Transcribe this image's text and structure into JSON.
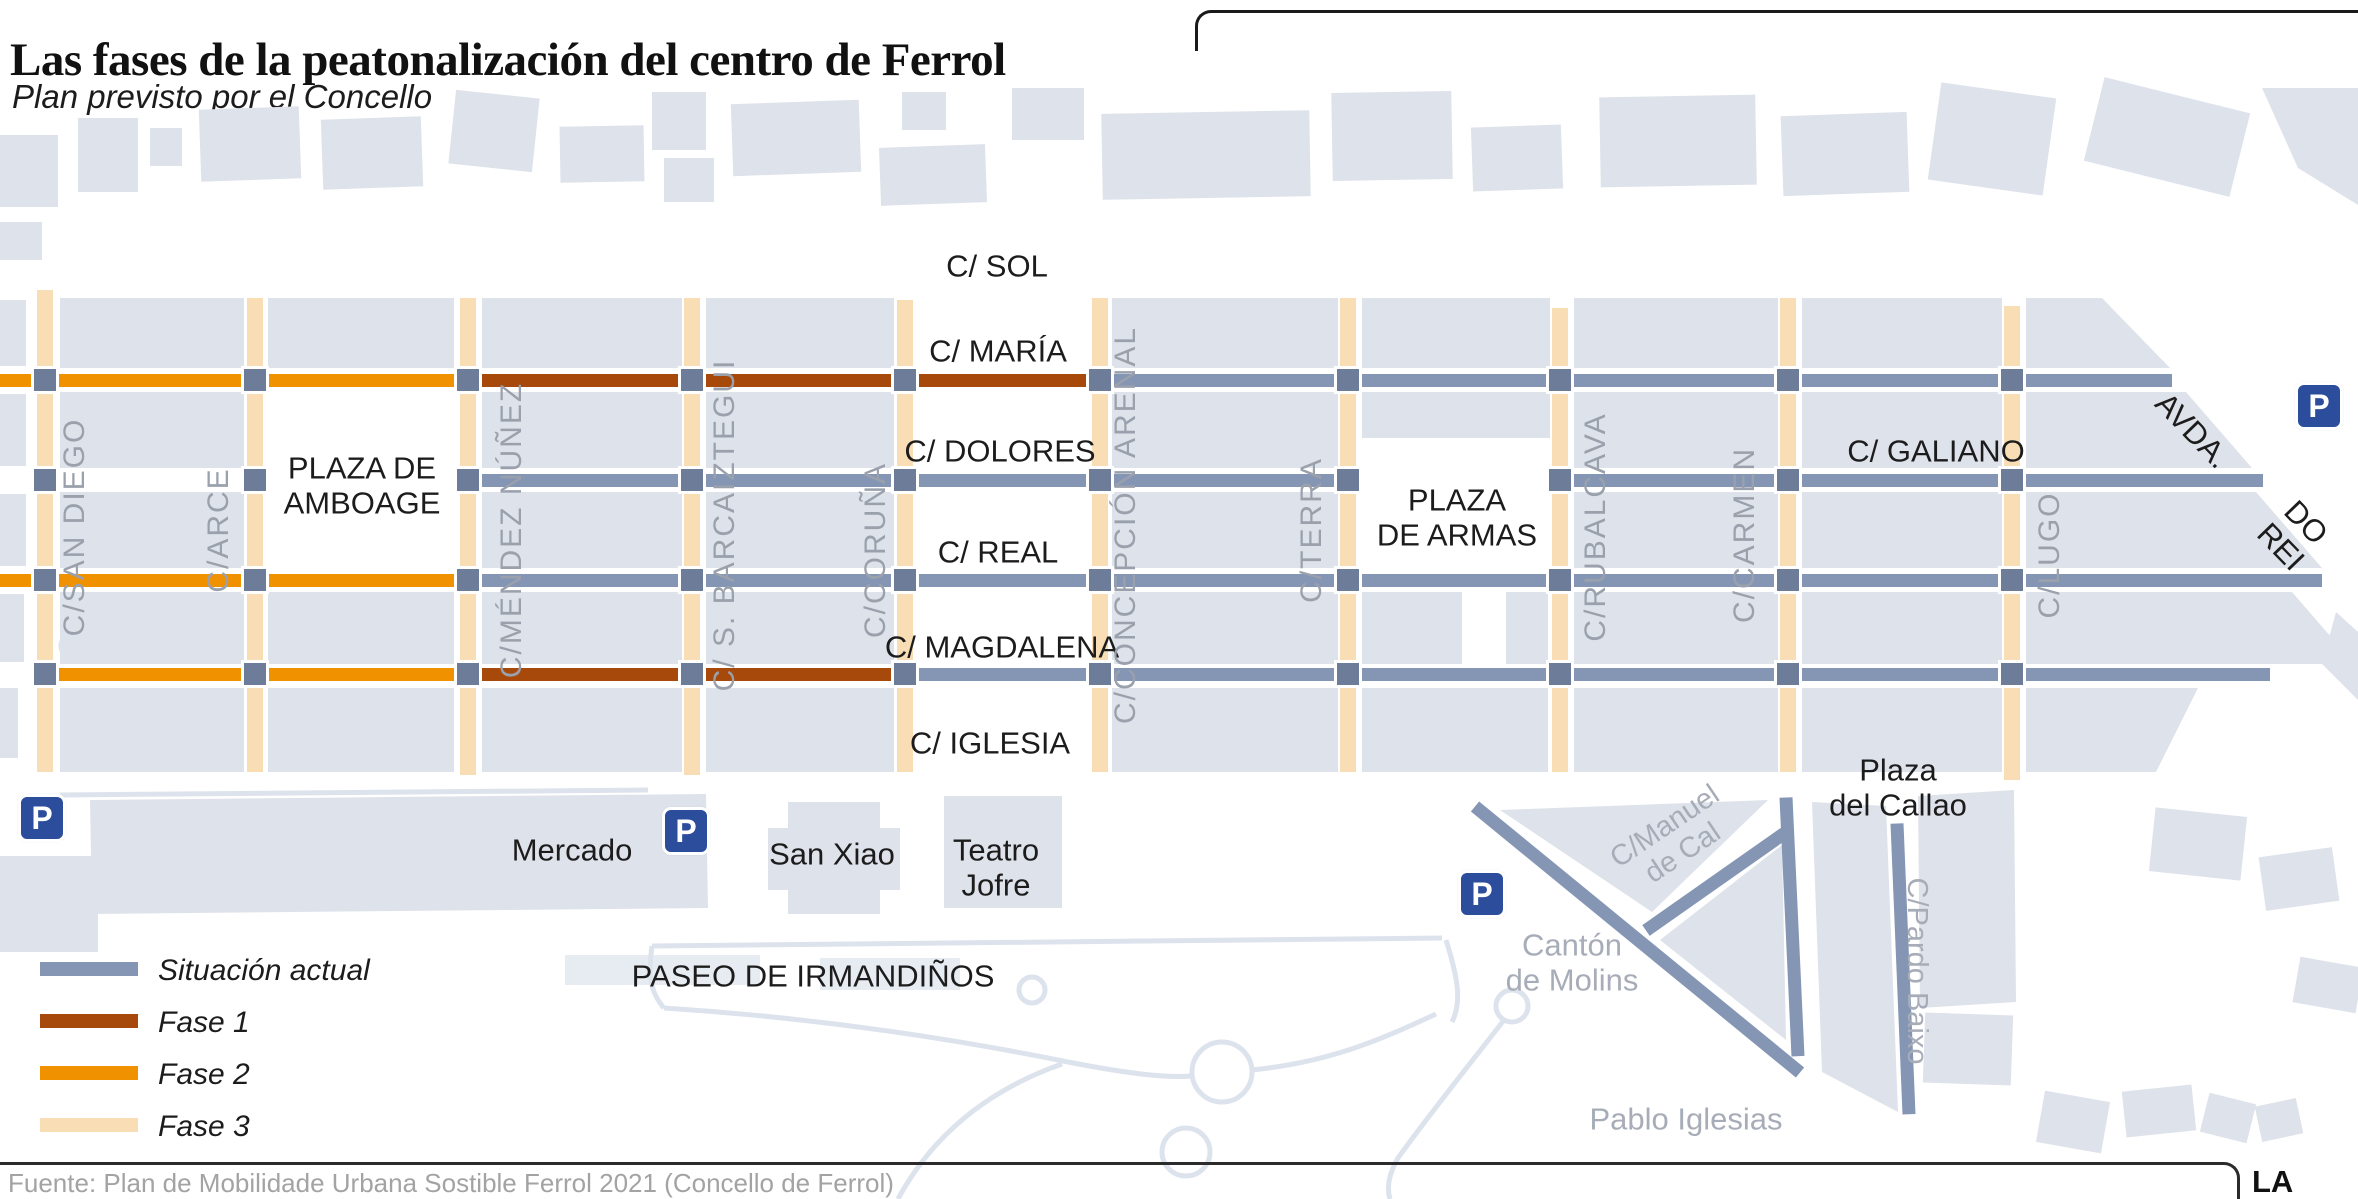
{
  "title": "Las fases de la peatonalización del centro de Ferrol",
  "subtitle": "Plan previsto por el Concello",
  "source": "Fuente: Plan de Mobilidade Urbana Sostible Ferrol 2021 (Concello de Ferrol)",
  "brand": "LA VOZ",
  "legend": {
    "items": [
      {
        "label": "Situación actual",
        "color": "#8496b4"
      },
      {
        "label": "Fase 1",
        "color": "#a8490c"
      },
      {
        "label": "Fase 2",
        "color": "#f09200"
      },
      {
        "label": "Fase 3",
        "color": "#f9ddb4"
      }
    ]
  },
  "colors": {
    "actual": "#8496b4",
    "fase1": "#a8490c",
    "fase2": "#f09200",
    "fase3": "#f9ddb4",
    "square": "#6c7c99",
    "building": "#dee2ea",
    "building_light": "#e7ebf2",
    "path": "#dde3ec",
    "parking_bg": "#2b4d9c",
    "label_black": "#1c1c1c",
    "label_gray_street": "#9aa1ac",
    "label_gray_place": "#a7adb8"
  },
  "map": {
    "parking_label": "P",
    "parking": [
      {
        "x": 42,
        "y": 818
      },
      {
        "x": 686,
        "y": 831
      },
      {
        "x": 1482,
        "y": 894
      },
      {
        "x": 2319,
        "y": 406
      }
    ],
    "v_streets": [
      {
        "name": "san-diego",
        "x": 45,
        "y1": 290,
        "y2": 772
      },
      {
        "name": "arce",
        "x": 255,
        "y1": 298,
        "y2": 772
      },
      {
        "name": "mendez-nunez",
        "x": 468,
        "y1": 298,
        "y2": 775
      },
      {
        "name": "barcaiztegui",
        "x": 692,
        "y1": 298,
        "y2": 775
      },
      {
        "name": "coruna",
        "x": 905,
        "y1": 300,
        "y2": 772
      },
      {
        "name": "concepcion-arenal",
        "x": 1100,
        "y1": 298,
        "y2": 772
      },
      {
        "name": "terra",
        "x": 1348,
        "y1": 298,
        "y2": 772
      },
      {
        "name": "rubalcava",
        "x": 1560,
        "y1": 308,
        "y2": 772
      },
      {
        "name": "carmen",
        "x": 1788,
        "y1": 298,
        "y2": 772
      },
      {
        "name": "lugo",
        "x": 2012,
        "y1": 306,
        "y2": 780
      }
    ],
    "h_segments": [
      {
        "name": "maria-fase2",
        "y": 380,
        "x1": 0,
        "x2": 466,
        "phase": "fase2"
      },
      {
        "name": "maria-fase1",
        "y": 380,
        "x1": 466,
        "x2": 1100,
        "phase": "fase1"
      },
      {
        "name": "maria-actual",
        "y": 380,
        "x1": 1100,
        "x2": 2172,
        "phase": "actual"
      },
      {
        "name": "dolores-actual",
        "y": 480,
        "x1": 466,
        "x2": 1348,
        "phase": "actual"
      },
      {
        "name": "galiano-actual",
        "y": 480,
        "x1": 1560,
        "x2": 2263,
        "phase": "actual"
      },
      {
        "name": "real-fase2",
        "y": 580,
        "x1": 0,
        "x2": 466,
        "phase": "fase2"
      },
      {
        "name": "real-actual",
        "y": 580,
        "x1": 466,
        "x2": 2322,
        "phase": "actual"
      },
      {
        "name": "magdalena-fase2",
        "y": 674,
        "x1": 45,
        "x2": 466,
        "phase": "fase2"
      },
      {
        "name": "magdalena-fase1",
        "y": 674,
        "x1": 466,
        "x2": 905,
        "phase": "fase1"
      },
      {
        "name": "magdalena-actual",
        "y": 674,
        "x1": 905,
        "x2": 2270,
        "phase": "actual"
      }
    ],
    "d_segments": [
      {
        "name": "canton-diagonal",
        "x1": 1475,
        "y1": 806,
        "x2": 1800,
        "y2": 1072,
        "phase": "actual"
      },
      {
        "name": "canton-east",
        "x1": 1786,
        "y1": 797,
        "x2": 1798,
        "y2": 1056,
        "phase": "actual"
      },
      {
        "name": "canton-middle",
        "x1": 1646,
        "y1": 930,
        "x2": 1784,
        "y2": 833,
        "phase": "actual"
      },
      {
        "name": "pardo-baixo-line",
        "x1": 1897,
        "y1": 823,
        "x2": 1909,
        "y2": 1114,
        "phase": "actual"
      }
    ],
    "intersections": {
      "xs": [
        45,
        255,
        468,
        692,
        905,
        1100,
        1348,
        1560,
        1788,
        2012
      ],
      "ys": [
        380,
        480,
        580,
        674
      ]
    },
    "labels": [
      {
        "name": "label-c-sol",
        "text": "C/ SOL",
        "x": 997,
        "y": 267,
        "s": 31,
        "c": "label_black"
      },
      {
        "name": "label-c-maria",
        "text": "C/ MARÍA",
        "x": 998,
        "y": 352,
        "s": 31,
        "c": "label_black"
      },
      {
        "name": "label-c-dolores",
        "text": "C/ DOLORES",
        "x": 1000,
        "y": 452,
        "s": 31,
        "c": "label_black"
      },
      {
        "name": "label-c-real",
        "text": "C/ REAL",
        "x": 998,
        "y": 553,
        "s": 31,
        "c": "label_black"
      },
      {
        "name": "label-c-magdalena",
        "text": "C/ MAGDALENA",
        "x": 1002,
        "y": 648,
        "s": 31,
        "c": "label_black"
      },
      {
        "name": "label-c-iglesia",
        "text": "C/ IGLESIA",
        "x": 990,
        "y": 744,
        "s": 31,
        "c": "label_black"
      },
      {
        "name": "label-plaza-amboage",
        "text": "PLAZA DE\nAMBOAGE",
        "x": 362,
        "y": 486,
        "s": 31,
        "c": "label_black"
      },
      {
        "name": "label-plaza-armas",
        "text": "PLAZA\nDE ARMAS",
        "x": 1457,
        "y": 518,
        "s": 31,
        "c": "label_black"
      },
      {
        "name": "label-c-galiano",
        "text": "C/ GALIANO",
        "x": 1936,
        "y": 452,
        "s": 31,
        "c": "label_black"
      },
      {
        "name": "label-avda",
        "text": "AVDA.",
        "x": 2192,
        "y": 431,
        "s": 31,
        "r": 46,
        "c": "label_black"
      },
      {
        "name": "label-do-rei",
        "text": "DO REI",
        "x": 2293,
        "y": 535,
        "s": 31,
        "r": 46,
        "c": "label_black"
      },
      {
        "name": "label-mercado",
        "text": "Mercado",
        "x": 572,
        "y": 851,
        "s": 31,
        "c": "label_black"
      },
      {
        "name": "label-san-xiao",
        "text": "San Xiao",
        "x": 832,
        "y": 855,
        "s": 31,
        "c": "label_black"
      },
      {
        "name": "label-teatro-jofre",
        "text": "Teatro\nJofre",
        "x": 996,
        "y": 868,
        "s": 31,
        "c": "label_black"
      },
      {
        "name": "label-paseo-irmandinos",
        "text": "PASEO DE IRMANDIÑOS",
        "x": 813,
        "y": 977,
        "s": 31,
        "c": "label_black"
      },
      {
        "name": "label-plaza-callao",
        "text": "Plaza\ndel Callao",
        "x": 1898,
        "y": 788,
        "s": 31,
        "c": "label_black"
      },
      {
        "name": "label-canton-molins",
        "text": "Cantón\nde Molins",
        "x": 1572,
        "y": 963,
        "s": 31,
        "c": "label_gray_place"
      },
      {
        "name": "label-pablo-iglesias",
        "text": "Pablo Iglesias",
        "x": 1686,
        "y": 1120,
        "s": 31,
        "c": "label_gray_place"
      },
      {
        "name": "label-manuel-de-cal",
        "text": "C/Manuel\nde Cal",
        "x": 1674,
        "y": 840,
        "s": 29,
        "r": -34,
        "c": "label_gray_place"
      },
      {
        "name": "label-pardo-baixo",
        "text": "C/Pardo Baixo",
        "x": 1917,
        "y": 971,
        "s": 29,
        "r": 90,
        "c": "label_gray_place"
      },
      {
        "name": "label-san-diego",
        "text": "C/SAN DIEGO",
        "x": 75,
        "y": 527,
        "s": 30,
        "r": -90,
        "ls": 2,
        "c": "label_gray_street"
      },
      {
        "name": "label-arce",
        "text": "C/ARCE",
        "x": 219,
        "y": 530,
        "s": 30,
        "r": -90,
        "ls": 2,
        "c": "label_gray_street"
      },
      {
        "name": "label-mendez-nunez",
        "text": "C/MÉNDEZ NÚÑEZ",
        "x": 512,
        "y": 530,
        "s": 30,
        "r": -90,
        "ls": 2,
        "c": "label_gray_street"
      },
      {
        "name": "label-barcaiztegui",
        "text": "C/ S. BARCAIZTEGUI",
        "x": 725,
        "y": 525,
        "s": 30,
        "r": -90,
        "ls": 2,
        "c": "label_gray_street"
      },
      {
        "name": "label-coruna",
        "text": "C/CORUÑA",
        "x": 876,
        "y": 550,
        "s": 30,
        "r": -90,
        "ls": 2,
        "c": "label_gray_street"
      },
      {
        "name": "label-concepcion-arenal",
        "text": "C/CONCEPCIÓN ARENAL",
        "x": 1126,
        "y": 525,
        "s": 30,
        "r": -90,
        "ls": 2,
        "c": "label_gray_street"
      },
      {
        "name": "label-terra",
        "text": "C/TERRA",
        "x": 1312,
        "y": 530,
        "s": 30,
        "r": -90,
        "ls": 2,
        "c": "label_gray_street"
      },
      {
        "name": "label-rubalcava",
        "text": "C/RUBALCAVA",
        "x": 1596,
        "y": 527,
        "s": 30,
        "r": -90,
        "ls": 2,
        "c": "label_gray_street"
      },
      {
        "name": "label-carmen",
        "text": "C/CARMEN",
        "x": 1745,
        "y": 535,
        "s": 30,
        "r": -90,
        "ls": 2,
        "c": "label_gray_street"
      },
      {
        "name": "label-lugo",
        "text": "C/LUGO",
        "x": 2050,
        "y": 555,
        "s": 30,
        "r": -90,
        "ls": 2,
        "c": "label_gray_street"
      }
    ],
    "buildings": {
      "rects": [
        {
          "x": 0,
          "y": 135,
          "w": 58,
          "h": 72
        },
        {
          "x": 0,
          "y": 222,
          "w": 42,
          "h": 38
        },
        {
          "x": 78,
          "y": 118,
          "w": 60,
          "h": 74
        },
        {
          "x": 150,
          "y": 128,
          "w": 32,
          "h": 38
        },
        {
          "x": 200,
          "y": 108,
          "w": 100,
          "h": 72,
          "rot": -2
        },
        {
          "x": 322,
          "y": 118,
          "w": 100,
          "h": 70,
          "rot": -2
        },
        {
          "x": 452,
          "y": 94,
          "w": 84,
          "h": 74,
          "rot": 6
        },
        {
          "x": 560,
          "y": 126,
          "w": 84,
          "h": 56,
          "rot": -1
        },
        {
          "x": 652,
          "y": 92,
          "w": 54,
          "h": 58
        },
        {
          "x": 664,
          "y": 158,
          "w": 50,
          "h": 44
        },
        {
          "x": 732,
          "y": 102,
          "w": 128,
          "h": 72,
          "rot": -2
        },
        {
          "x": 880,
          "y": 146,
          "w": 106,
          "h": 58,
          "rot": -2
        },
        {
          "x": 902,
          "y": 92,
          "w": 44,
          "h": 38
        },
        {
          "x": 1012,
          "y": 88,
          "w": 72,
          "h": 52
        },
        {
          "x": 1102,
          "y": 112,
          "w": 208,
          "h": 86,
          "rot": -1
        },
        {
          "x": 1332,
          "y": 92,
          "w": 120,
          "h": 88,
          "rot": -1
        },
        {
          "x": 1472,
          "y": 126,
          "w": 90,
          "h": 64,
          "rot": -2
        },
        {
          "x": 1600,
          "y": 96,
          "w": 156,
          "h": 90,
          "rot": -1
        },
        {
          "x": 1782,
          "y": 114,
          "w": 126,
          "h": 80,
          "rot": -2
        },
        {
          "x": 1934,
          "y": 90,
          "w": 116,
          "h": 98,
          "rot": 8
        },
        {
          "x": 2092,
          "y": 94,
          "w": 150,
          "h": 86,
          "rot": 14
        },
        {
          "x": 0,
          "y": 300,
          "w": 26,
          "h": 66
        },
        {
          "x": 0,
          "y": 394,
          "w": 26,
          "h": 72
        },
        {
          "x": 0,
          "y": 494,
          "w": 26,
          "h": 72
        },
        {
          "x": 0,
          "y": 594,
          "w": 24,
          "h": 68
        },
        {
          "x": 0,
          "y": 688,
          "w": 18,
          "h": 70
        },
        {
          "x": 60,
          "y": 298,
          "w": 184,
          "h": 70
        },
        {
          "x": 268,
          "y": 298,
          "w": 186,
          "h": 70
        },
        {
          "x": 482,
          "y": 298,
          "w": 200,
          "h": 70
        },
        {
          "x": 706,
          "y": 298,
          "w": 188,
          "h": 70
        },
        {
          "x": 1112,
          "y": 298,
          "w": 226,
          "h": 70
        },
        {
          "x": 1362,
          "y": 298,
          "w": 188,
          "h": 70
        },
        {
          "x": 1574,
          "y": 298,
          "w": 204,
          "h": 70
        },
        {
          "x": 1802,
          "y": 298,
          "w": 200,
          "h": 70
        },
        {
          "x": 60,
          "y": 392,
          "w": 184,
          "h": 76
        },
        {
          "x": 482,
          "y": 392,
          "w": 200,
          "h": 76
        },
        {
          "x": 706,
          "y": 392,
          "w": 188,
          "h": 76
        },
        {
          "x": 1112,
          "y": 392,
          "w": 226,
          "h": 76
        },
        {
          "x": 1362,
          "y": 392,
          "w": 188,
          "h": 46
        },
        {
          "x": 1574,
          "y": 392,
          "w": 204,
          "h": 76
        },
        {
          "x": 1802,
          "y": 392,
          "w": 200,
          "h": 76
        },
        {
          "x": 60,
          "y": 492,
          "w": 184,
          "h": 76
        },
        {
          "x": 482,
          "y": 492,
          "w": 200,
          "h": 76
        },
        {
          "x": 706,
          "y": 492,
          "w": 188,
          "h": 76
        },
        {
          "x": 1112,
          "y": 492,
          "w": 226,
          "h": 76
        },
        {
          "x": 1574,
          "y": 492,
          "w": 204,
          "h": 76
        },
        {
          "x": 1802,
          "y": 492,
          "w": 200,
          "h": 76
        },
        {
          "x": 60,
          "y": 592,
          "w": 184,
          "h": 72
        },
        {
          "x": 268,
          "y": 592,
          "w": 186,
          "h": 72
        },
        {
          "x": 482,
          "y": 592,
          "w": 200,
          "h": 72
        },
        {
          "x": 706,
          "y": 592,
          "w": 188,
          "h": 72
        },
        {
          "x": 1112,
          "y": 592,
          "w": 226,
          "h": 72
        },
        {
          "x": 1362,
          "y": 592,
          "w": 100,
          "h": 72
        },
        {
          "x": 1506,
          "y": 592,
          "w": 42,
          "h": 72
        },
        {
          "x": 1574,
          "y": 592,
          "w": 204,
          "h": 72
        },
        {
          "x": 1802,
          "y": 592,
          "w": 200,
          "h": 72
        },
        {
          "x": 60,
          "y": 688,
          "w": 184,
          "h": 84
        },
        {
          "x": 268,
          "y": 688,
          "w": 186,
          "h": 84
        },
        {
          "x": 482,
          "y": 688,
          "w": 200,
          "h": 84
        },
        {
          "x": 706,
          "y": 688,
          "w": 188,
          "h": 84
        },
        {
          "x": 1112,
          "y": 688,
          "w": 226,
          "h": 84
        },
        {
          "x": 1362,
          "y": 688,
          "w": 186,
          "h": 84
        },
        {
          "x": 1574,
          "y": 688,
          "w": 204,
          "h": 84
        },
        {
          "x": 1802,
          "y": 688,
          "w": 200,
          "h": 84
        },
        {
          "x": 788,
          "y": 802,
          "w": 92,
          "h": 112
        },
        {
          "x": 768,
          "y": 828,
          "w": 132,
          "h": 62
        },
        {
          "x": 944,
          "y": 796,
          "w": 118,
          "h": 112
        },
        {
          "x": 0,
          "y": 856,
          "w": 98,
          "h": 96
        },
        {
          "x": 1924,
          "y": 1014,
          "w": 88,
          "h": 70,
          "rot": 2
        },
        {
          "x": 2152,
          "y": 812,
          "w": 92,
          "h": 64,
          "rot": 6
        },
        {
          "x": 2262,
          "y": 852,
          "w": 74,
          "h": 54,
          "rot": -8
        },
        {
          "x": 2296,
          "y": 962,
          "w": 64,
          "h": 46,
          "rot": 10
        },
        {
          "x": 2040,
          "y": 1096,
          "w": 66,
          "h": 52,
          "rot": 10
        },
        {
          "x": 2124,
          "y": 1088,
          "w": 70,
          "h": 46,
          "rot": -6
        },
        {
          "x": 2204,
          "y": 1098,
          "w": 48,
          "h": 40,
          "rot": 14
        },
        {
          "x": 2258,
          "y": 1102,
          "w": 42,
          "h": 36,
          "rot": -12
        }
      ],
      "rects_light": [
        {
          "x": 565,
          "y": 955,
          "w": 195,
          "h": 30
        },
        {
          "x": 820,
          "y": 958,
          "w": 140,
          "h": 32
        }
      ],
      "polys": [
        "2026,298 2102,298 2170,368 2026,368",
        "2026,392 2186,392 2252,468 2026,468",
        "2026,492 2256,492 2322,568 2026,568",
        "2026,592 2292,592 2344,652 2336,664 2026,664",
        "2026,688 2198,688 2156,772 2026,772",
        "2262,88 2358,88 2358,205 2298,168",
        "2336,612 2358,632 2358,700 2322,664",
        "90,800 706,794 708,908 92,914",
        "1500,810 1768,800 1652,912",
        "1660,940 1782,845 1786,1040",
        "1812,802 1886,806 1898,1112 1822,1072",
        "1918,796 2014,790 2016,1002 1920,1008"
      ],
      "strokes": [
        "M 652,946 L 1442,938",
        "M 652,946 C 648,975 650,992 664,1008",
        "M 664,1008 C 820,1018 960,1040 1068,1062 C 1130,1074 1166,1078 1192,1076",
        "M 1252,1070 C 1330,1062 1380,1040 1436,1014",
        "M 1504,1020 C 1470,1064 1428,1116 1398,1158 C 1390,1172 1386,1186 1390,1199",
        "M 898,1199 C 930,1140 982,1092 1062,1064",
        "M 60,795 L 648,790",
        "M 1446,940 C 1458,978 1462,1002 1452,1022"
      ],
      "circles": [
        {
          "cx": 1222,
          "cy": 1072,
          "r": 30
        },
        {
          "cx": 1512,
          "cy": 1006,
          "r": 16
        },
        {
          "cx": 1032,
          "cy": 990,
          "r": 13
        },
        {
          "cx": 1186,
          "cy": 1152,
          "r": 24
        },
        {
          "cx": 72,
          "cy": 646,
          "r": 11
        }
      ]
    }
  }
}
